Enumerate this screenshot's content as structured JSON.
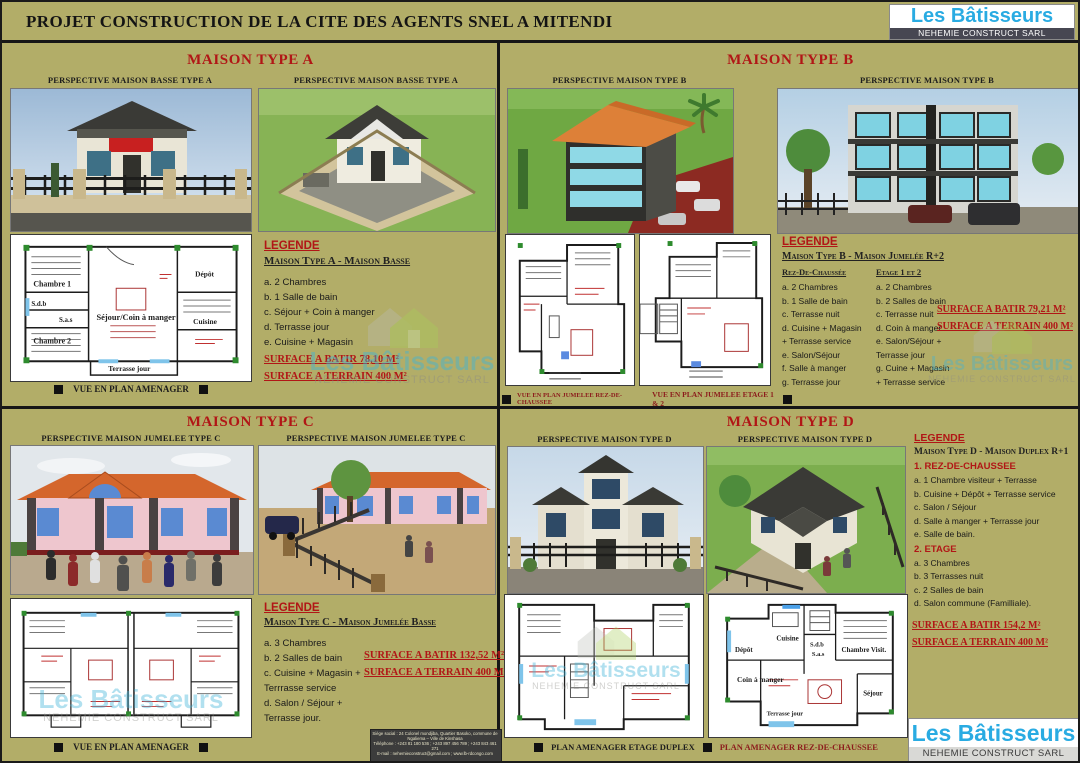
{
  "header": {
    "title": "PROJET CONSTRUCTION DE LA CITE DES AGENTS SNEL A MITENDI",
    "brand": {
      "name": "Les Bâtisseurs",
      "subtitle": "NEHEMIE CONSTRUCT SARL"
    }
  },
  "colors": {
    "background": "#b2ad68",
    "accent_red": "#b11616",
    "brand_cyan": "#29abe2"
  },
  "sections": {
    "a": {
      "title": "MAISON TYPE A",
      "caption_left": "PERSPECTIVE MAISON BASSE TYPE A",
      "caption_right": "PERSPECTIVE MAISON BASSE TYPE A",
      "plan_caption": "VUE EN PLAN AMENAGER",
      "legend_heading": "LEGENDE",
      "legend_subheading": "Maison Type A - Maison Basse",
      "items": [
        "a. 2 Chambres",
        "b. 1 Salle de bain",
        "c. Séjour + Coin à manger",
        "d. Terrasse jour",
        "e. Cuisine + Magasin"
      ],
      "surface_batir": "SURFACE A BATIR 78,10 M²",
      "surface_terrain": "SURFACE A TERRAIN 400 M²",
      "plan_rooms": [
        "Chambre 1",
        "S.d.b",
        "S.a.s",
        "Chambre 2",
        "Séjour/Coin à manger",
        "Dépôt",
        "Cuisine",
        "Terrasse jour"
      ]
    },
    "b": {
      "title": "MAISON TYPE B",
      "caption_left": "PERSPECTIVE MAISON TYPE B",
      "caption_right": "PERSPECTIVE MAISON TYPE B",
      "legend_heading": "LEGENDE",
      "legend_subheading": "Maison Type B - Maison Jumelée R+2",
      "col1_title": "Rez-De-Chaussée",
      "col1_items": [
        "a. 2 Chambres",
        "b. 1 Salle de bain",
        "c. Terrasse nuit",
        "d. Cuisine + Magasin",
        "+ Terrasse service",
        "e. Salon/Séjour",
        "f. Salle à manger",
        "g. Terrasse jour"
      ],
      "col2_title": "Etage 1 et 2",
      "col2_items": [
        "a. 2 Chambres",
        "b. 2 Salles de bain",
        "c. Terrasse nuit",
        "d. Coin à manger",
        "e. Salon/Séjour +",
        "Terrasse jour",
        "g. Cuine + Magasin",
        "+ Terrasse service"
      ],
      "surface_batir": "SURFACE A BATIR 79,21 M²",
      "surface_terrain": "SURFACE A TERRAIN 400 M²",
      "plan_caption_left": "VUE EN PLAN JUMELEE REZ-DE-CHAUSSEE",
      "plan_caption_right": "VUE EN PLAN JUMELEE ETAGE 1 & 2"
    },
    "c": {
      "title": "MAISON TYPE C",
      "caption_left": "PERSPECTIVE MAISON JUMELEE TYPE C",
      "caption_right": "PERSPECTIVE MAISON JUMELEE TYPE C",
      "plan_caption": "VUE EN PLAN AMENAGER",
      "legend_heading": "LEGENDE",
      "legend_subheading": "Maison Type C - Maison Jumelée Basse",
      "items": [
        "a. 3 Chambres",
        "b. 2 Salles de bain",
        "c. Cuisine + Magasin +",
        "Terrrasse service",
        "d. Salon / Séjour +",
        "Terrasse jour."
      ],
      "surface_batir": "SURFACE A BATIR 132,52 M²",
      "surface_terrain": "SURFACE A TERRAIN 400 M²"
    },
    "d": {
      "title": "MAISON TYPE D",
      "caption_left": "PERSPECTIVE MAISON TYPE D",
      "caption_right": "PERSPECTIVE MAISON TYPE D",
      "legend_heading": "LEGENDE",
      "legend_subheading": "Maison Type D - Maison Duplex R+1",
      "group1_title": "1. REZ-DE-CHAUSSEE",
      "group1_items": [
        "a. 1 Chambre visiteur + Terrasse",
        "b. Cuisine + Dépôt + Terrasse service",
        "c. Salon / Séjour",
        "d. Salle à manger + Terrasse jour",
        "e. Salle de bain."
      ],
      "group2_title": "2. ETAGE",
      "group2_items": [
        "a. 3 Chambres",
        "b. 3 Terrasses nuit",
        "c. 2 Salles de bain",
        "d. Salon commune (Familliale)."
      ],
      "surface_batir": "SURFACE A BATIR 154,2 M²",
      "surface_terrain": "SURFACE A TERRAIN 400 M²",
      "plan_caption_left": "PLAN AMENAGER ETAGE DUPLEX",
      "plan_caption_right": "PLAN AMENAGER REZ-DE-CHAUSSEE",
      "plan_rooms": [
        "Dépôt",
        "Cuisine",
        "S.d.b",
        "S.a.s",
        "Chambre Visit.",
        "Coin à manger",
        "Séjour",
        "Terrasse jour"
      ]
    }
  },
  "footer": {
    "contact_line1": "Siège social : 24 Colonel mondjiba, Quartier Basoko, commune de Ngaliema – Ville de Kinshasa",
    "contact_line2": "Téléphone : +243 81 180 536 ; +243 897 456 789 ; +243 843 461 271",
    "contact_line3": "E-mail : nehemieconstruct@gmail.com ; www.lb-rdcongo.com"
  }
}
